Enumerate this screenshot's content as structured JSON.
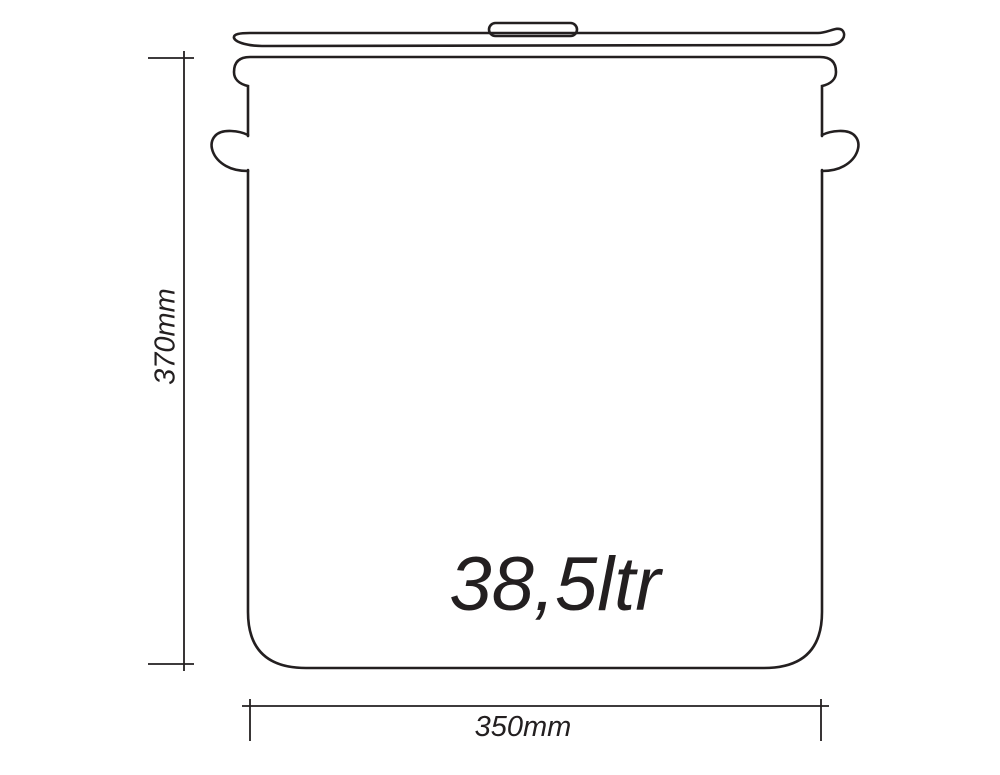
{
  "diagram": {
    "capacity_label": "38,5ltr",
    "height_label": "370mm",
    "width_label": "350mm"
  },
  "colors": {
    "line": "#231f20",
    "background": "#ffffff"
  }
}
